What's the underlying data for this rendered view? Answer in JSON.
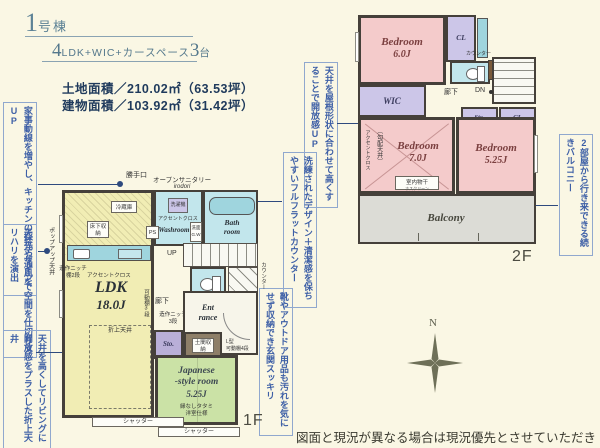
{
  "header": {
    "building_no": "1",
    "building_suffix": "号棟",
    "layout_prefix": "4",
    "layout_text": "LDK+WIC+カースペース",
    "layout_count": "3",
    "layout_tail": "台",
    "land_area": "土地面積／210.02㎡（63.53坪）",
    "building_area": "建物面積／103.92㎡（31.42坪）"
  },
  "annotations": [
    "家事動線を増やし、キッチンの採光や通風をUP",
    "天井デザインで空間を仕切りメリハリを演出",
    "天井を高くしてリビングに開放感をプラスした折上天井",
    "天井を屋根形状に合わせて高くすることで開放感UP",
    "洗練されたデザイン＋清潔感を保ちやすいフルフラットカウンター",
    "靴やアウトドア用品も汚れを気にせず収納でき玄関スッキリ",
    "2部屋から行き来できる続きバルコニー"
  ],
  "floor1": {
    "floor_label": "1F",
    "ldk_name": "LDK",
    "ldk_size": "18.0J",
    "back_door": "勝手口",
    "popup_ceiling": "ポップアップ天井",
    "fridge": "冷蔵庫",
    "floor_storage": "床下収納",
    "accent_cloth": "アクセントクロス",
    "niche_kitchen_1": "造作ニッチ",
    "niche_kitchen_2": "棚2段",
    "folded_ceiling": "折上天井",
    "movable_shelf": "可動棚3段",
    "open_sanitary": "オープンサニタリー",
    "open_sanitary_sub": "irodori",
    "washroom_name": "Washroom",
    "washer": "洗濯機",
    "accent_cloth_wash": "アクセントクロス",
    "vanity_1": "洗面",
    "vanity_2": "G.W",
    "bath_1": "Bath",
    "bath_2": "room",
    "ps": "PS",
    "up": "UP",
    "hallway": "廊下",
    "niche_hall_1": "造作ニッチ",
    "niche_hall_2": "3段",
    "counter_side": "カウンター",
    "entrance_1": "Ent",
    "entrance_2": "rance",
    "sto": "Sto.",
    "doma_storage": "土間収納",
    "l_shelf_1": "L型",
    "l_shelf_2": "可動棚4段",
    "jp_1": "Japanese",
    "jp_2": "-style room",
    "jp_3": "5.25J",
    "jp_note_1": "縁なしタタミ",
    "jp_note_2": "洋室仕様",
    "shutter": "シャッター"
  },
  "floor2": {
    "floor_label": "2F",
    "bedroom1_name": "Bedroom",
    "bedroom1_size": "6.0J",
    "bedroom2_name": "Bedroom",
    "bedroom2_size": "7.0J",
    "bedroom3_name": "Bedroom",
    "bedroom3_size": "5.25J",
    "cl_top": "CL",
    "cl_mid": "CL",
    "wic": "WIC",
    "sto": "Sto.",
    "counter": "カウンター",
    "dn": "DN",
    "hallway": "廊下",
    "flat_ceiling": "（平天井）",
    "sloped_ceiling": "〔勾配天井〕",
    "accent_cloth": "アクセントクロス",
    "drying_1": "室内物干",
    "drying_2": "ホスクリーン",
    "balcony": "Balcony"
  },
  "compass": {
    "north": "N"
  },
  "footer": {
    "disclaimer": "図面と現況が異なる場合は現況優先とさせていただきます。"
  },
  "colors": {
    "accent_blue": "#3D5FA6",
    "title_blue": "#5E8396",
    "area_navy": "#1F3A5C",
    "wall": "#45403A",
    "ldk_yellow": "#F1EDB4",
    "bedroom_pink": "#F4CBCB",
    "closet_lavender": "#CCC6E8",
    "tatami_green": "#CBE2A6",
    "water_cyan": "#C2E6EC",
    "counter_cyan": "#9FD5DE",
    "balcony_gray": "#DCDCD6",
    "paper_cream": "#FAF7E4"
  }
}
